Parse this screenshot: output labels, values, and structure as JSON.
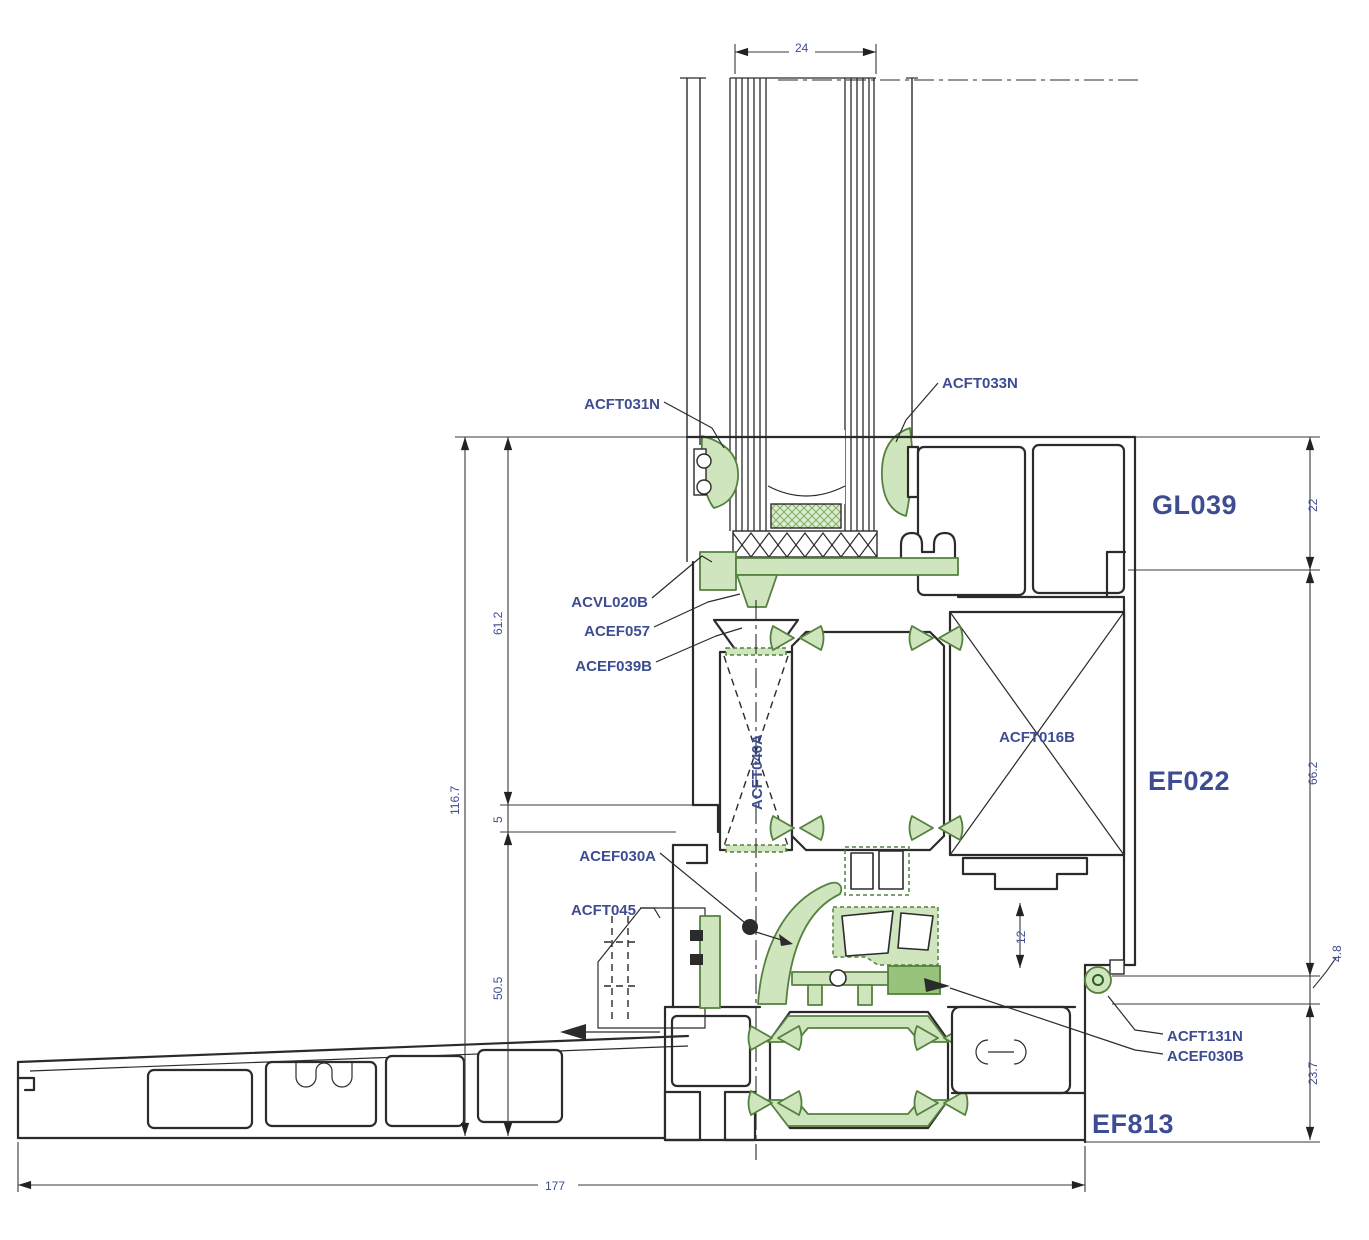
{
  "title": "Aluminium frame cross-section detail",
  "colors": {
    "line": "#2b2b2b",
    "thin": "#3a3a3a",
    "g": "#cfe5bd",
    "gd": "#97c47a",
    "gs": "#55813f",
    "lblc": "#3e4c92",
    "dimc": "#3e4c92"
  },
  "labels": {
    "acft031n": "ACFT031N",
    "acft033n": "ACFT033N",
    "acvl020b": "ACVL020B",
    "acef057": "ACEF057",
    "acef039b": "ACEF039B",
    "acef030a": "ACEF030A",
    "acft045": "ACFT045",
    "acft016b": "ACFT016B",
    "rotated_part": "ACFT040A",
    "acft131n": "ACFT131N",
    "acef030b": "ACEF030B",
    "gl039": "GL039",
    "ef022": "EF022",
    "ef813": "EF813"
  },
  "dimensions": {
    "glass_width": "24",
    "d22": "22",
    "d662": "66.2",
    "d48": "4.8",
    "d237": "23.7",
    "d12": "12",
    "d612": "61.2",
    "d5": "5",
    "d505": "50.5",
    "d1167": "116.7",
    "d177": "177"
  }
}
